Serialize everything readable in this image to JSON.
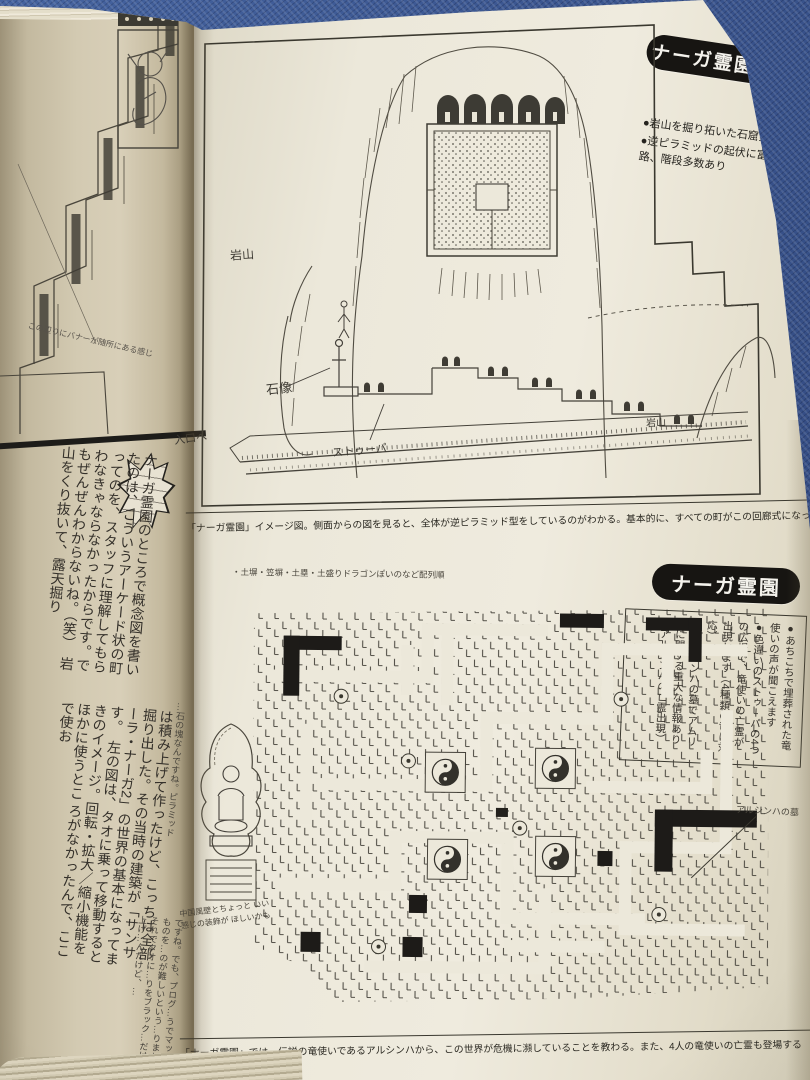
{
  "banners": {
    "concept": "ナーガ霊園概念",
    "map": "ナーガ霊園"
  },
  "concept_notes": [
    "●岩山を掘り拓いた石窟霊園",
    "●逆ピラミッドの起伏に富んだ迷路、階段多数あり"
  ],
  "illustration1": {
    "labels": {
      "iwayama_left": "岩山",
      "sekizo": "石像",
      "stupa": "ストゥーパ",
      "iwayama_right": "岩山",
      "entrance": "入口へ"
    },
    "caption": "「ナーガ霊園」イメージ図。側面からの図を見ると、全体が逆ピラミッド型をしているのがわかる。基本的に、すべての町がこの回廊式になっている"
  },
  "map_notes": [
    "●あちこちで埋葬された竜使いの声が聞こえます",
    "●色違いのストゥーパの4つの広場で、竜使いの亡霊が出現します（4種類の竜に対応）",
    "●アルシンハの墓でアムリタに関する重大な情報あり（アルシンハの亡霊出現）"
  ],
  "maze": {
    "annotation": "・土塀・笠塀・土塁・土盛りドラゴンぽいのなど配列順",
    "tomb_label": "アルシンハの墓",
    "deity_note": "中国風壁とちょっと いい感じの装飾が ほしいかも"
  },
  "map_caption": "「ナーガ霊園」では、伝説の竜使いであるアルシンハから、この世界が危機に瀕していることを教わる。また、4人の竜使いの亡霊も登場する",
  "left_page": {
    "sketch_note": "この辺りにバナーが随所にある感じ",
    "interview_1": "ナーガ霊園のところで概念図を書いたのは、こういうアーケード状の町ってのを、スタッフに理解してもらわなきゃならなかったからです。でもぜんぜんわからないね。（笑）　岩山をくり抜いて、露天掘り",
    "interview_2_lead": "…石の塊なんですね。ピラミッド",
    "interview_2": "は積み上げて作ったけど、こっちは全部掘り出した。その当時の建築が「サンサーラ・ナーガ2」の世界の基本になってます。　左の図は、タオに乗って移動するときのイメージ。回転・拡大／縮小機能をほかに使うとこ ろがなかったんで、ここで使お",
    "interview_small": "ですね。でも、プログ…うでマップそのものを…のが難しいという…りました。それでタオに…りをブラック…だけ打ち上げ…んだけど、…"
  }
}
